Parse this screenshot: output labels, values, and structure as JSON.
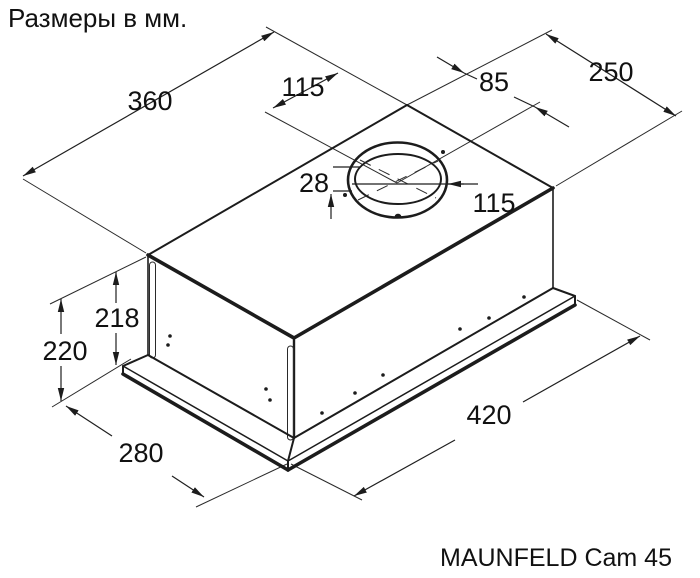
{
  "title": "Размеры в мм.",
  "caption": "MAUNFELD Cam 45",
  "drawing": {
    "object": "built-in cooker hood, isometric dimensional drawing",
    "line_color": "#1c1c1c",
    "background": "#ffffff"
  },
  "dimensions": {
    "top_width": "360",
    "duct_offset_rear": "115",
    "duct_offset_side": "85",
    "top_edge": "250",
    "duct_collar_height": "28",
    "duct_diameter": "115",
    "body_height": "218",
    "overall_height": "220",
    "depth": "280",
    "width": "420"
  }
}
